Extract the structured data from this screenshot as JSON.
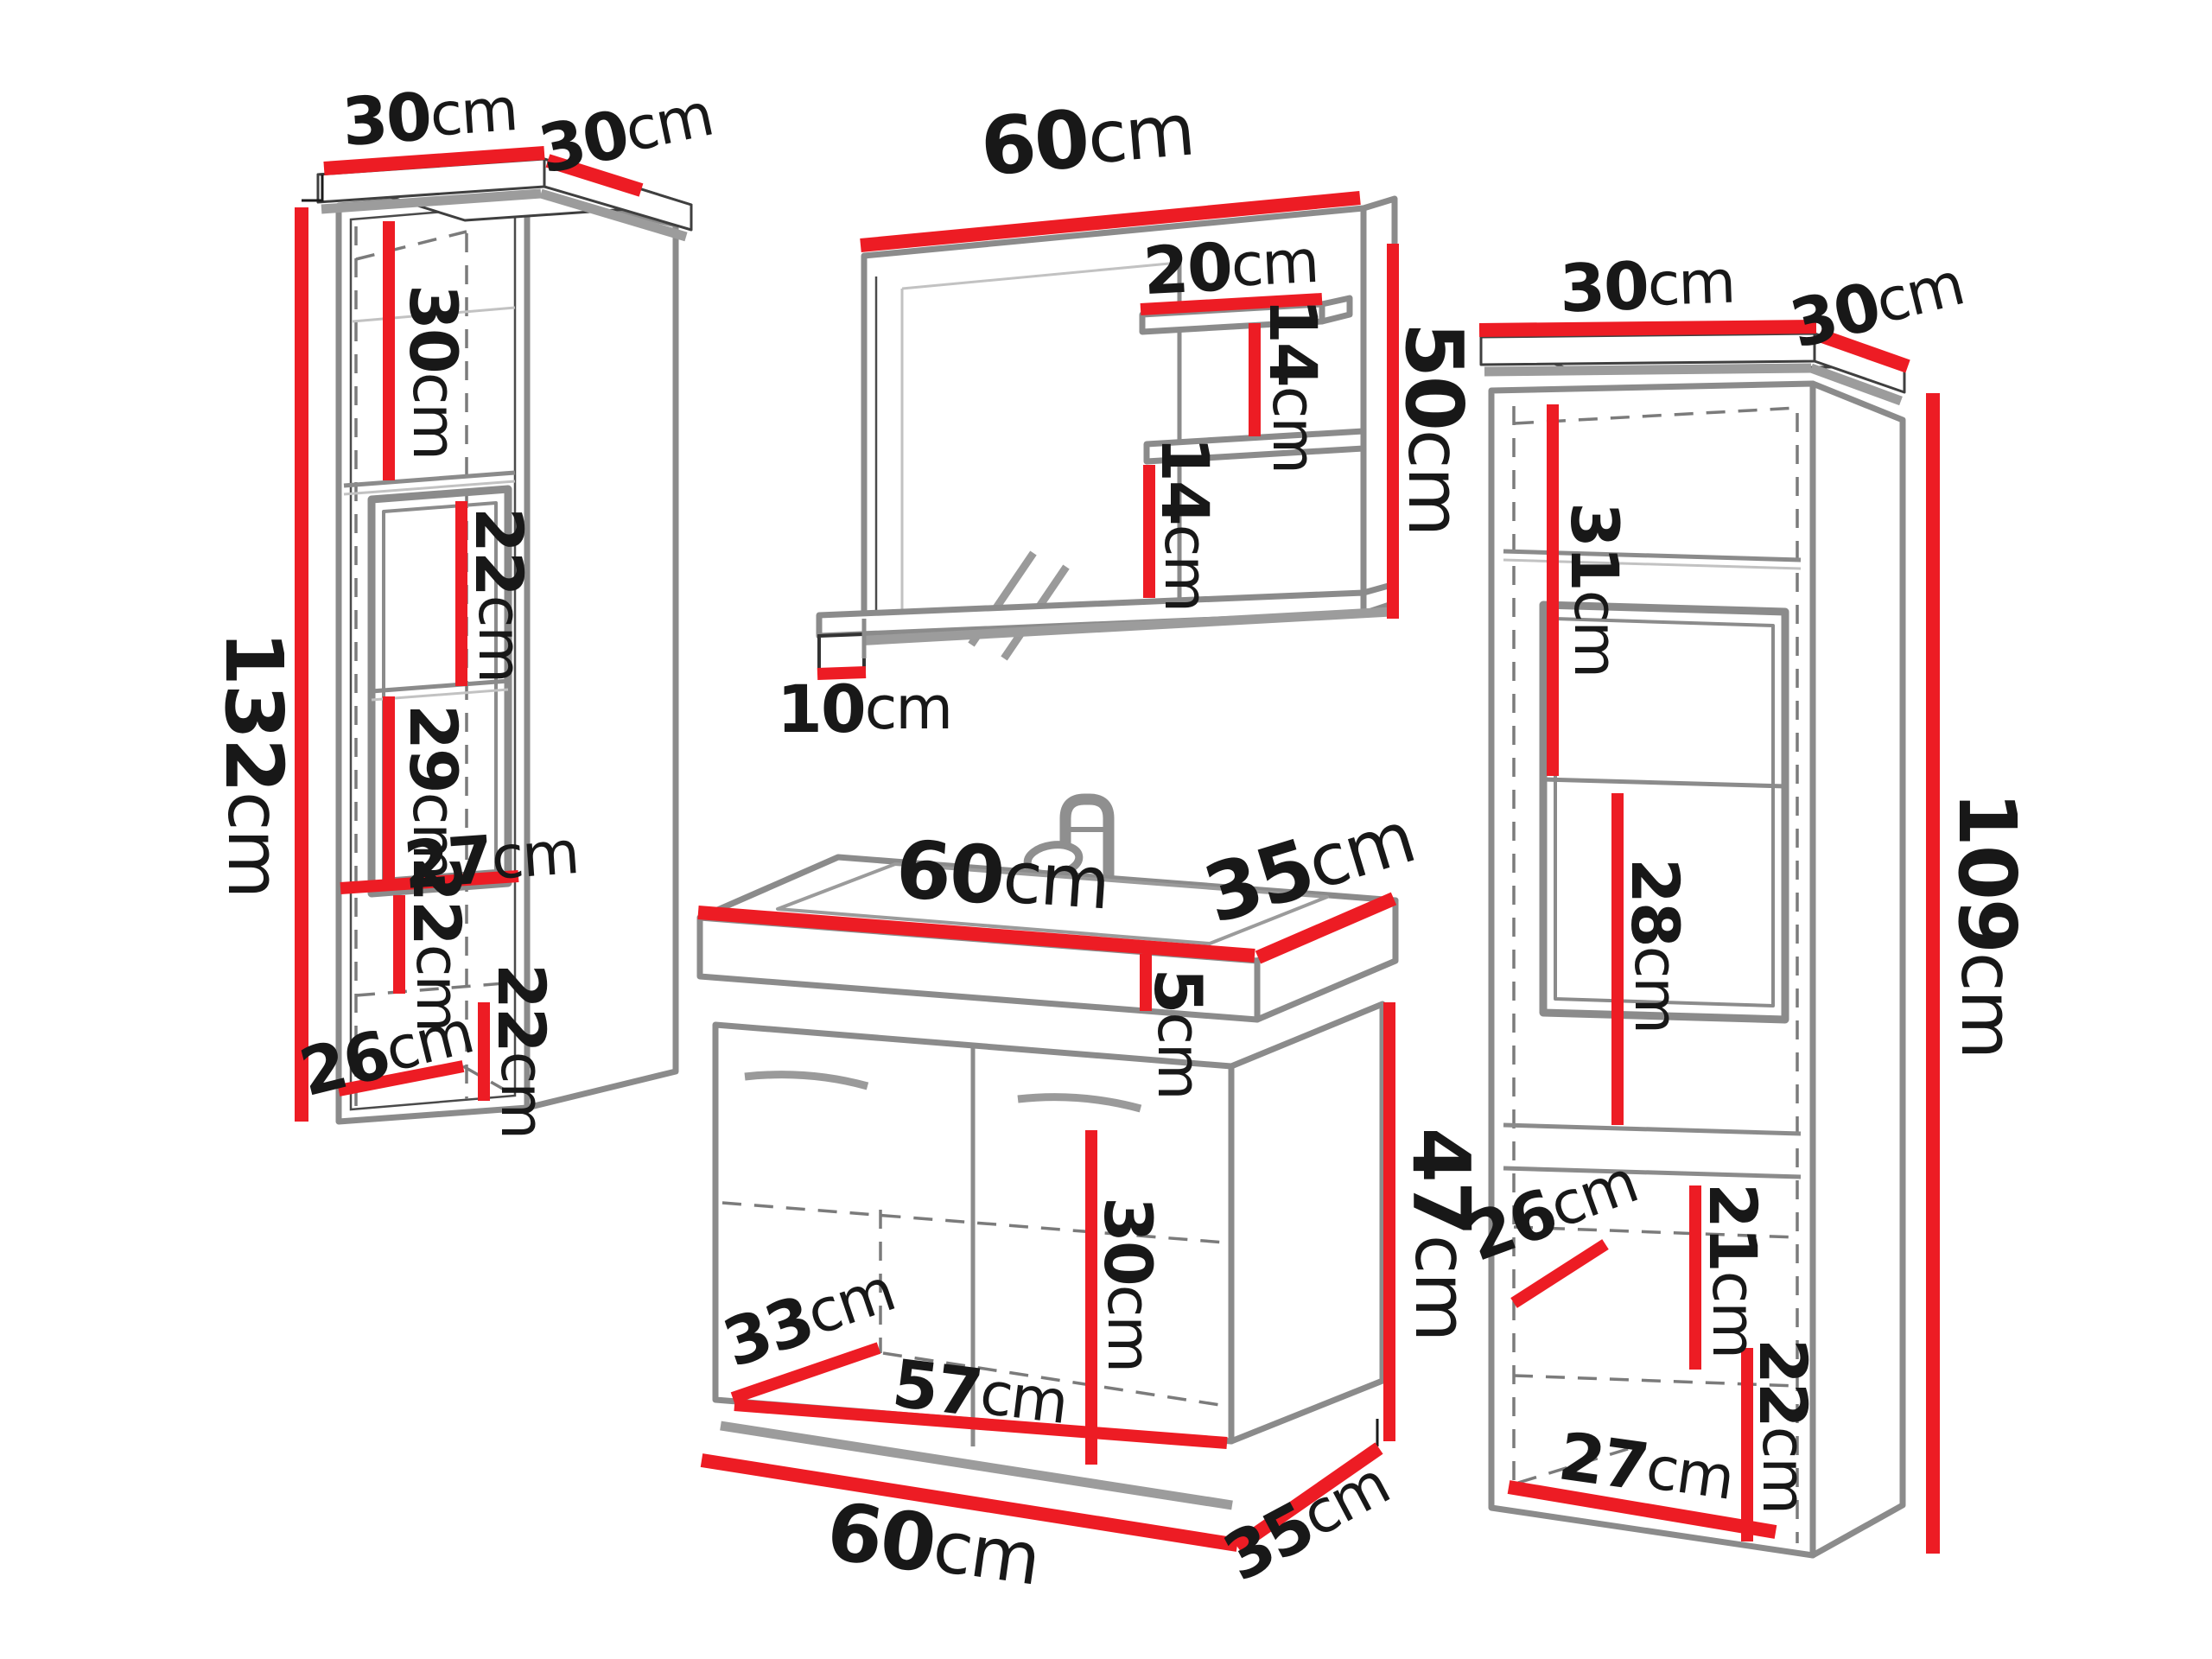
{
  "colors": {
    "dimension_red": "#ed1c24",
    "outline_gray": "#8b8b8b",
    "shadow_gray": "#9c9c9c",
    "dash_gray": "#7b7b7b",
    "crown_dark": "#3f3f3f",
    "text_black": "#181818",
    "background": "#ffffff"
  },
  "labels": {
    "left": {
      "top_width": {
        "value": "30",
        "unit": "cm"
      },
      "top_depth": {
        "value": "30",
        "unit": "cm"
      },
      "height": {
        "value": "132",
        "unit": "cm"
      },
      "sec1": {
        "value": "30",
        "unit": "cm"
      },
      "sec2": {
        "value": "22",
        "unit": "cm"
      },
      "sec3": {
        "value": "29",
        "unit": "cm"
      },
      "inner_width": {
        "value": "27",
        "unit": "cm"
      },
      "sec4": {
        "value": "22",
        "unit": "cm"
      },
      "bottom_depth": {
        "value": "26",
        "unit": "cm"
      },
      "sec5": {
        "value": "22",
        "unit": "cm"
      }
    },
    "mirror": {
      "width": {
        "value": "60",
        "unit": "cm"
      },
      "shelf_width": {
        "value": "20",
        "unit": "cm"
      },
      "gap1": {
        "value": "14",
        "unit": "cm"
      },
      "height": {
        "value": "50",
        "unit": "cm"
      },
      "gap2": {
        "value": "14",
        "unit": "cm"
      },
      "shelf_depth": {
        "value": "10",
        "unit": "cm"
      }
    },
    "sink": {
      "top_width": {
        "value": "60",
        "unit": "cm"
      },
      "top_depth": {
        "value": "35",
        "unit": "cm"
      },
      "basin_height": {
        "value": "5",
        "unit": "cm"
      },
      "body_height": {
        "value": "47",
        "unit": "cm"
      },
      "inner_height": {
        "value": "30",
        "unit": "cm"
      },
      "inner_depth": {
        "value": "33",
        "unit": "cm"
      },
      "inner_width": {
        "value": "57",
        "unit": "cm"
      },
      "bottom_width": {
        "value": "60",
        "unit": "cm"
      },
      "bottom_depth": {
        "value": "35",
        "unit": "cm"
      }
    },
    "right": {
      "top_width": {
        "value": "30",
        "unit": "cm"
      },
      "top_depth": {
        "value": "30",
        "unit": "cm"
      },
      "sec1": {
        "value": "31",
        "unit": "cm"
      },
      "sec2": {
        "value": "28",
        "unit": "cm"
      },
      "height": {
        "value": "109",
        "unit": "cm"
      },
      "bottom_depth": {
        "value": "26",
        "unit": "cm"
      },
      "sec3": {
        "value": "21",
        "unit": "cm"
      },
      "sec4": {
        "value": "22",
        "unit": "cm"
      },
      "bottom_width": {
        "value": "27",
        "unit": "cm"
      }
    }
  }
}
